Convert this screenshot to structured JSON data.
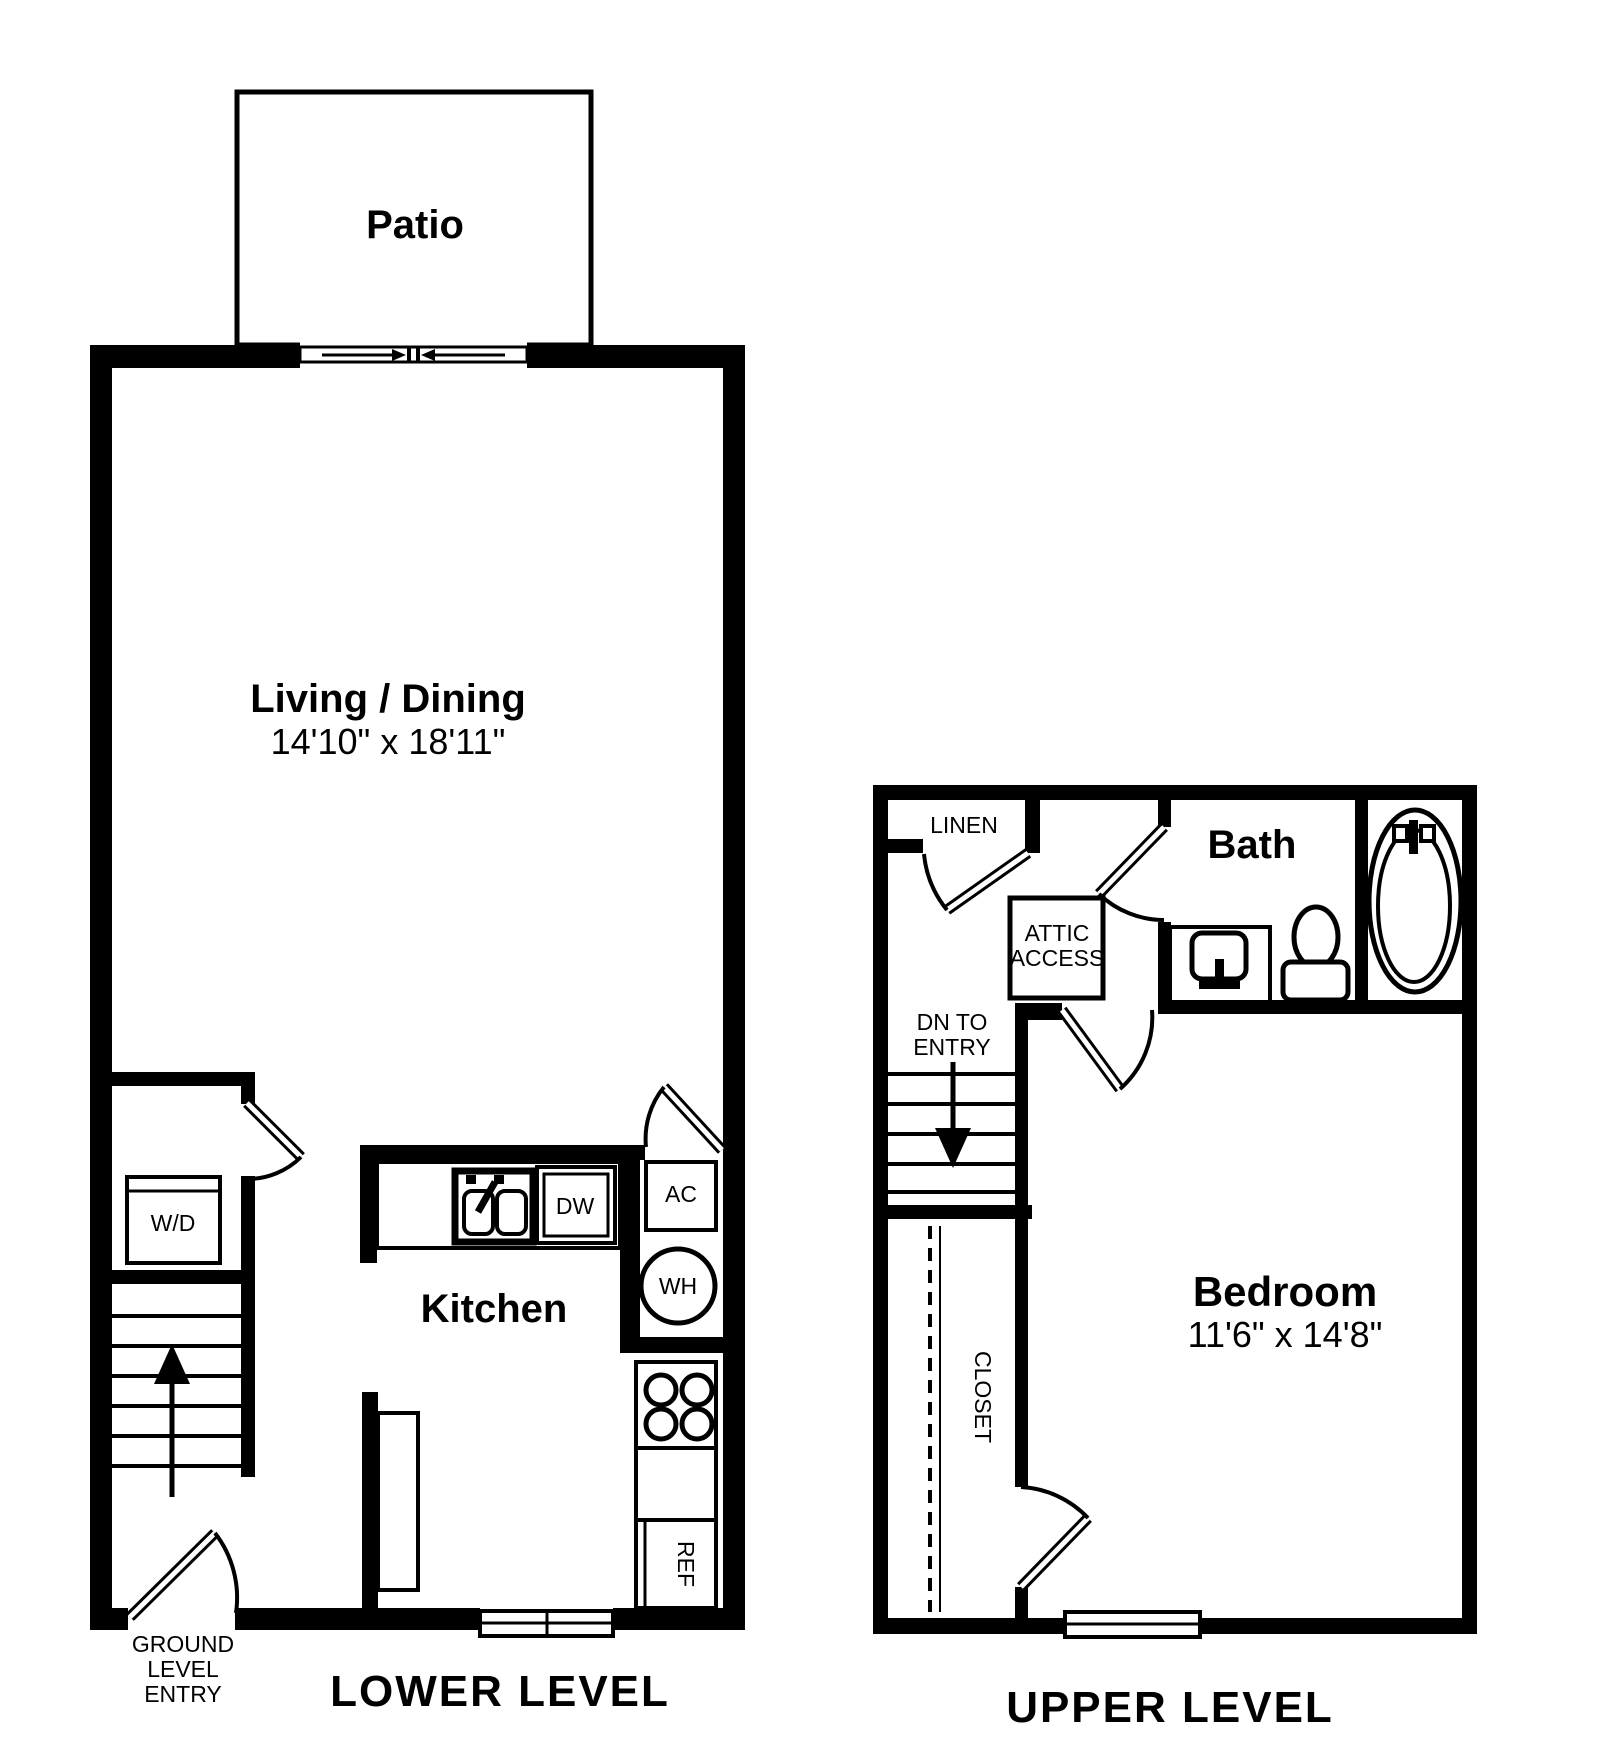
{
  "colors": {
    "wall": "#000000",
    "background": "#ffffff"
  },
  "lower_level": {
    "caption": "LOWER LEVEL",
    "patio": {
      "label": "Patio"
    },
    "living_dining": {
      "label": "Living / Dining",
      "dimensions": "14'10\" x 18'11\""
    },
    "kitchen": {
      "label": "Kitchen"
    },
    "appliances": {
      "washer_dryer": "W/D",
      "dishwasher": "DW",
      "air_conditioner": "AC",
      "water_heater": "WH",
      "refrigerator": "REF"
    },
    "entry_label": {
      "line1": "GROUND",
      "line2": "LEVEL",
      "line3": "ENTRY"
    }
  },
  "upper_level": {
    "caption": "UPPER LEVEL",
    "bath": {
      "label": "Bath"
    },
    "linen": {
      "label": "LINEN"
    },
    "attic_access": {
      "line1": "ATTIC",
      "line2": "ACCESS"
    },
    "stairs_note": {
      "line1": "DN TO",
      "line2": "ENTRY"
    },
    "bedroom": {
      "label": "Bedroom",
      "dimensions": "11'6\" x 14'8\""
    },
    "closet": {
      "label": "CLOSET"
    }
  }
}
